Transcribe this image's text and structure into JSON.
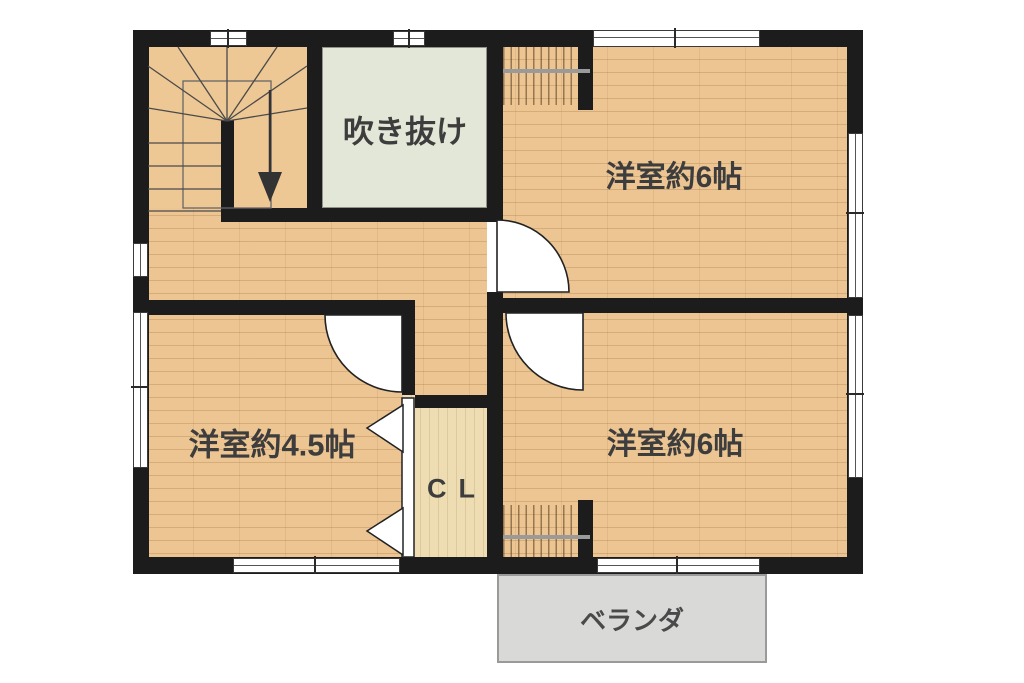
{
  "floorplan": {
    "type": "japanese-residential-floor-plan",
    "floor_note": "second floor with stairwell and atrium void",
    "rooms": {
      "bedroom_ne": {
        "label": "洋室約6帖",
        "meaning": "Western-style room approx. 6 tatami"
      },
      "bedroom_se": {
        "label": "洋室約6帖",
        "meaning": "Western-style room approx. 6 tatami"
      },
      "bedroom_w": {
        "label": "洋室約4.5帖",
        "meaning": "Western-style room approx. 4.5 tatami"
      },
      "void": {
        "label": "吹き抜け",
        "meaning": "atrium / open ceiling void"
      },
      "closet": {
        "label": "CL",
        "meaning": "closet"
      },
      "balcony": {
        "label": "ベランダ",
        "meaning": "veranda / balcony"
      }
    },
    "symbols": {
      "stairs": "winder staircase with down arrow",
      "doors": "three hinged door swing arcs, one bifold closet door (triangles)",
      "windows": "white wall gaps with tick dividers",
      "closet_rods": "two hanger-rod closets (top-right room, bottom-right room)"
    },
    "colors": {
      "wall": "#1c1c1c",
      "wood_floor": "#ecc593",
      "void_room": "#e3e7d8",
      "closet_floor": "#eeddb2",
      "balcony": "#d9d9d7",
      "text": "#3d3d3d",
      "background": "#ffffff"
    }
  }
}
